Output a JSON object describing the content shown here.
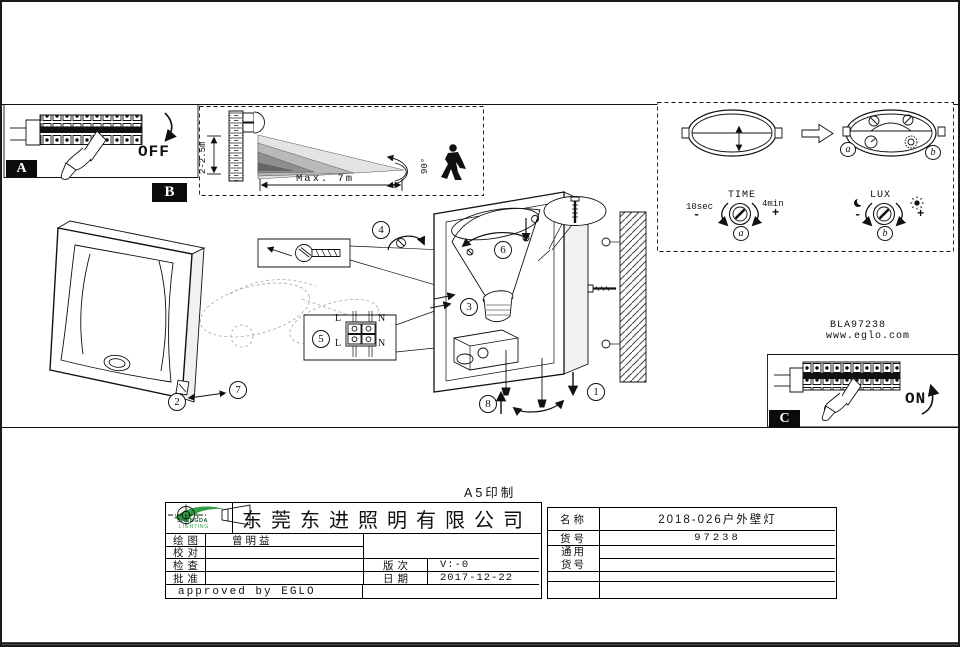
{
  "page": {
    "print_note": "A5印制"
  },
  "panel_a": {
    "label": "A",
    "state": "OFF"
  },
  "panel_b": {
    "label": "B",
    "mount_height": "2-2.5m",
    "range": "Max. 7m",
    "angle": "90°"
  },
  "panel_c": {
    "label": "C",
    "state": "ON"
  },
  "sensor_controls": {
    "time": {
      "title": "TIME",
      "min": "10sec",
      "max": "4min",
      "minus": "-",
      "plus": "+",
      "dial": "a"
    },
    "lux": {
      "title": "LUX",
      "minus": "-",
      "plus": "+",
      "dial": "b"
    },
    "dial_a": "a",
    "dial_b": "b"
  },
  "parts": {
    "p1": "1",
    "p2": "2",
    "p3": "3",
    "p4": "4",
    "p5": "5",
    "p6": "6",
    "p7": "7",
    "p8": "8"
  },
  "wiring": {
    "top_left": "L",
    "top_right": "N",
    "bottom_left": "L",
    "bottom_right": "N"
  },
  "reference": {
    "model": "BLA97238",
    "website": "www.eglo.com"
  },
  "title_block": {
    "logo_brand": "SHENGDA",
    "logo_sub": "LIGHTING",
    "company": "东莞东进照明有限公司",
    "rows": [
      {
        "label": "绘图",
        "value": "曾明益"
      },
      {
        "label": "校对",
        "value": ""
      },
      {
        "label": "检查",
        "value": ""
      },
      {
        "label": "批准",
        "value": ""
      }
    ],
    "revision_label": "版次",
    "revision": "V:-0",
    "date_label": "日期",
    "date": "2017-12-22",
    "approved": "approved by EGLO",
    "name_label": "名称",
    "name": "2018-026户外壁灯",
    "item_label": "货号",
    "item": "97238",
    "common_item_label": "通用货号"
  }
}
